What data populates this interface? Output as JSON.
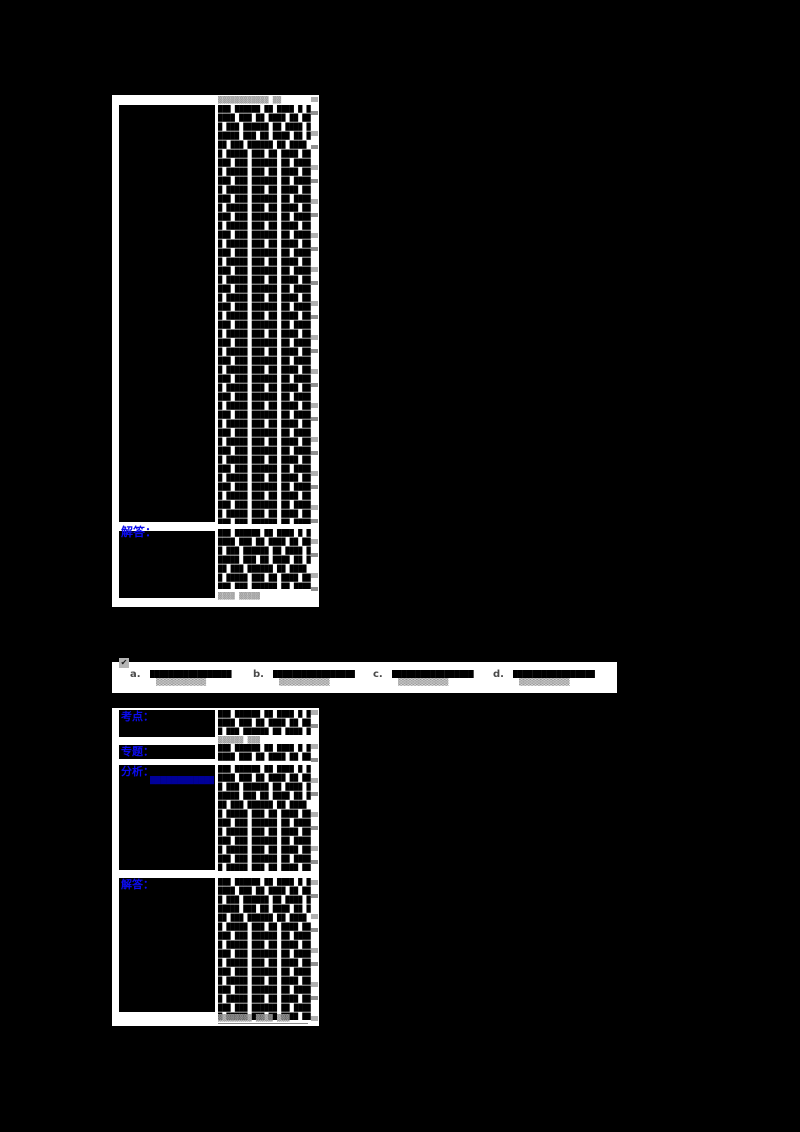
{
  "colors": {
    "page_background": "#000000",
    "cell_background": "#ffffff",
    "label_blue": "#0b0bee",
    "link_navy": "#000099",
    "muted_gray": "#9a9a9a"
  },
  "question_block": {
    "stem": {
      "header": "▓▓▓▓▓▓▓▓▓▓▓▓ ▓▓",
      "body_pattern": "███ ██████ ██ ████ █ █████ ███ ██ ████ ██ ███ "
    },
    "answer": {
      "label": "解答：",
      "body_pattern": "███ ██████ ██ ████ █ █████ ███ ██ ████ ██ ███ ",
      "footer": "▓▓▓▓ ▓▓▓▓▓"
    }
  },
  "options_bar": {
    "checkbox_glyph": "✔",
    "options": [
      {
        "letter": "a.",
        "blank": "█████████████████",
        "caption": "▒▒▒▒▒▒▒▒▒▒▒▒"
      },
      {
        "letter": "b.",
        "blank": "█████████████████",
        "caption": "▒▒▒▒▒▒▒▒▒▒▒▒"
      },
      {
        "letter": "c.",
        "blank": "█████████████████",
        "caption": "▒▒▒▒▒▒▒▒▒▒▒▒"
      },
      {
        "letter": "d.",
        "blank": "█████████████████",
        "caption": "▒▒▒▒▒▒▒▒▒▒▒▒"
      }
    ]
  },
  "solution_block": {
    "rows": [
      {
        "label": "考点：",
        "body_pattern": "███ ██████ ██ ████ █ █████ ███ ██ ████ ██ ███ ",
        "footer": "▓▓▓▓▓▓ ▓▓▓"
      },
      {
        "label": "专题：",
        "body_pattern": "███ ██████ ██ ████ █ █████ ███ ██ ████ ██ ███ "
      },
      {
        "label": "分析：",
        "link": "████████████",
        "body_pattern": "███ ██████ ██ ████ █ █████ ███ ██ ████ ██ ███ "
      },
      {
        "label": "解答：",
        "body_pattern": "███ ██████ ██ ████ █ █████ ███ ██ ████ ██ ███ ",
        "footer": "▓▓▓▓▓▓▓▓ ▓▓▓▓ ▓▓▓"
      }
    ]
  }
}
